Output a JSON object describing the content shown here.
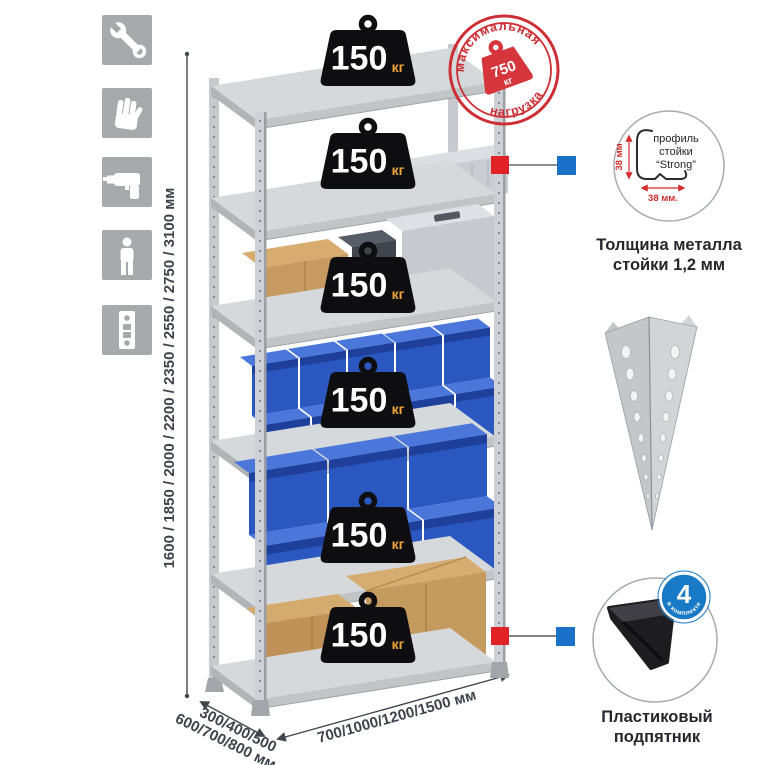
{
  "load_badge": {
    "value": "150",
    "unit": "кг"
  },
  "max_load_stamp": {
    "arc_top": "максимальная",
    "arc_bottom": "нагрузка",
    "value": "750",
    "unit": "кг"
  },
  "profile_detail": {
    "line1": "профиль",
    "line2": "стойки",
    "line3": "“Strong”",
    "dim_side": "38 мм",
    "dim_bottom": "38 мм.",
    "caption1": "Толщина металла",
    "caption2": "стойки 1,2 мм"
  },
  "foot_detail": {
    "badge_number": "4",
    "badge_caption": "в комплекте",
    "caption1": "Пластиковый",
    "caption2": "подпятник"
  },
  "dimensions": {
    "height_label": "1600 / 1850 / 2000 / 2200 / 2350 / 2550 / 2750 / 3100 мм",
    "depth_line1": "300/400/500",
    "depth_line2": "600/700/800 мм",
    "width_label": "700/1000/1200/1500 мм"
  },
  "icons": [
    "wrench-icon",
    "gloves-icon",
    "drill-icon",
    "person-icon",
    "rack-post-icon"
  ],
  "colors": {
    "stamp_red": "#cd2f35",
    "badge_black": "#0e0e10",
    "unit_orange": "#f0a43c",
    "marker_red": "#e02227",
    "marker_blue": "#1a71c7",
    "metal_light": "#d6d9dc",
    "bin_blue": "#2b57c0",
    "cardboard": "#c69a60",
    "icon_gray": "#a7aaad"
  }
}
